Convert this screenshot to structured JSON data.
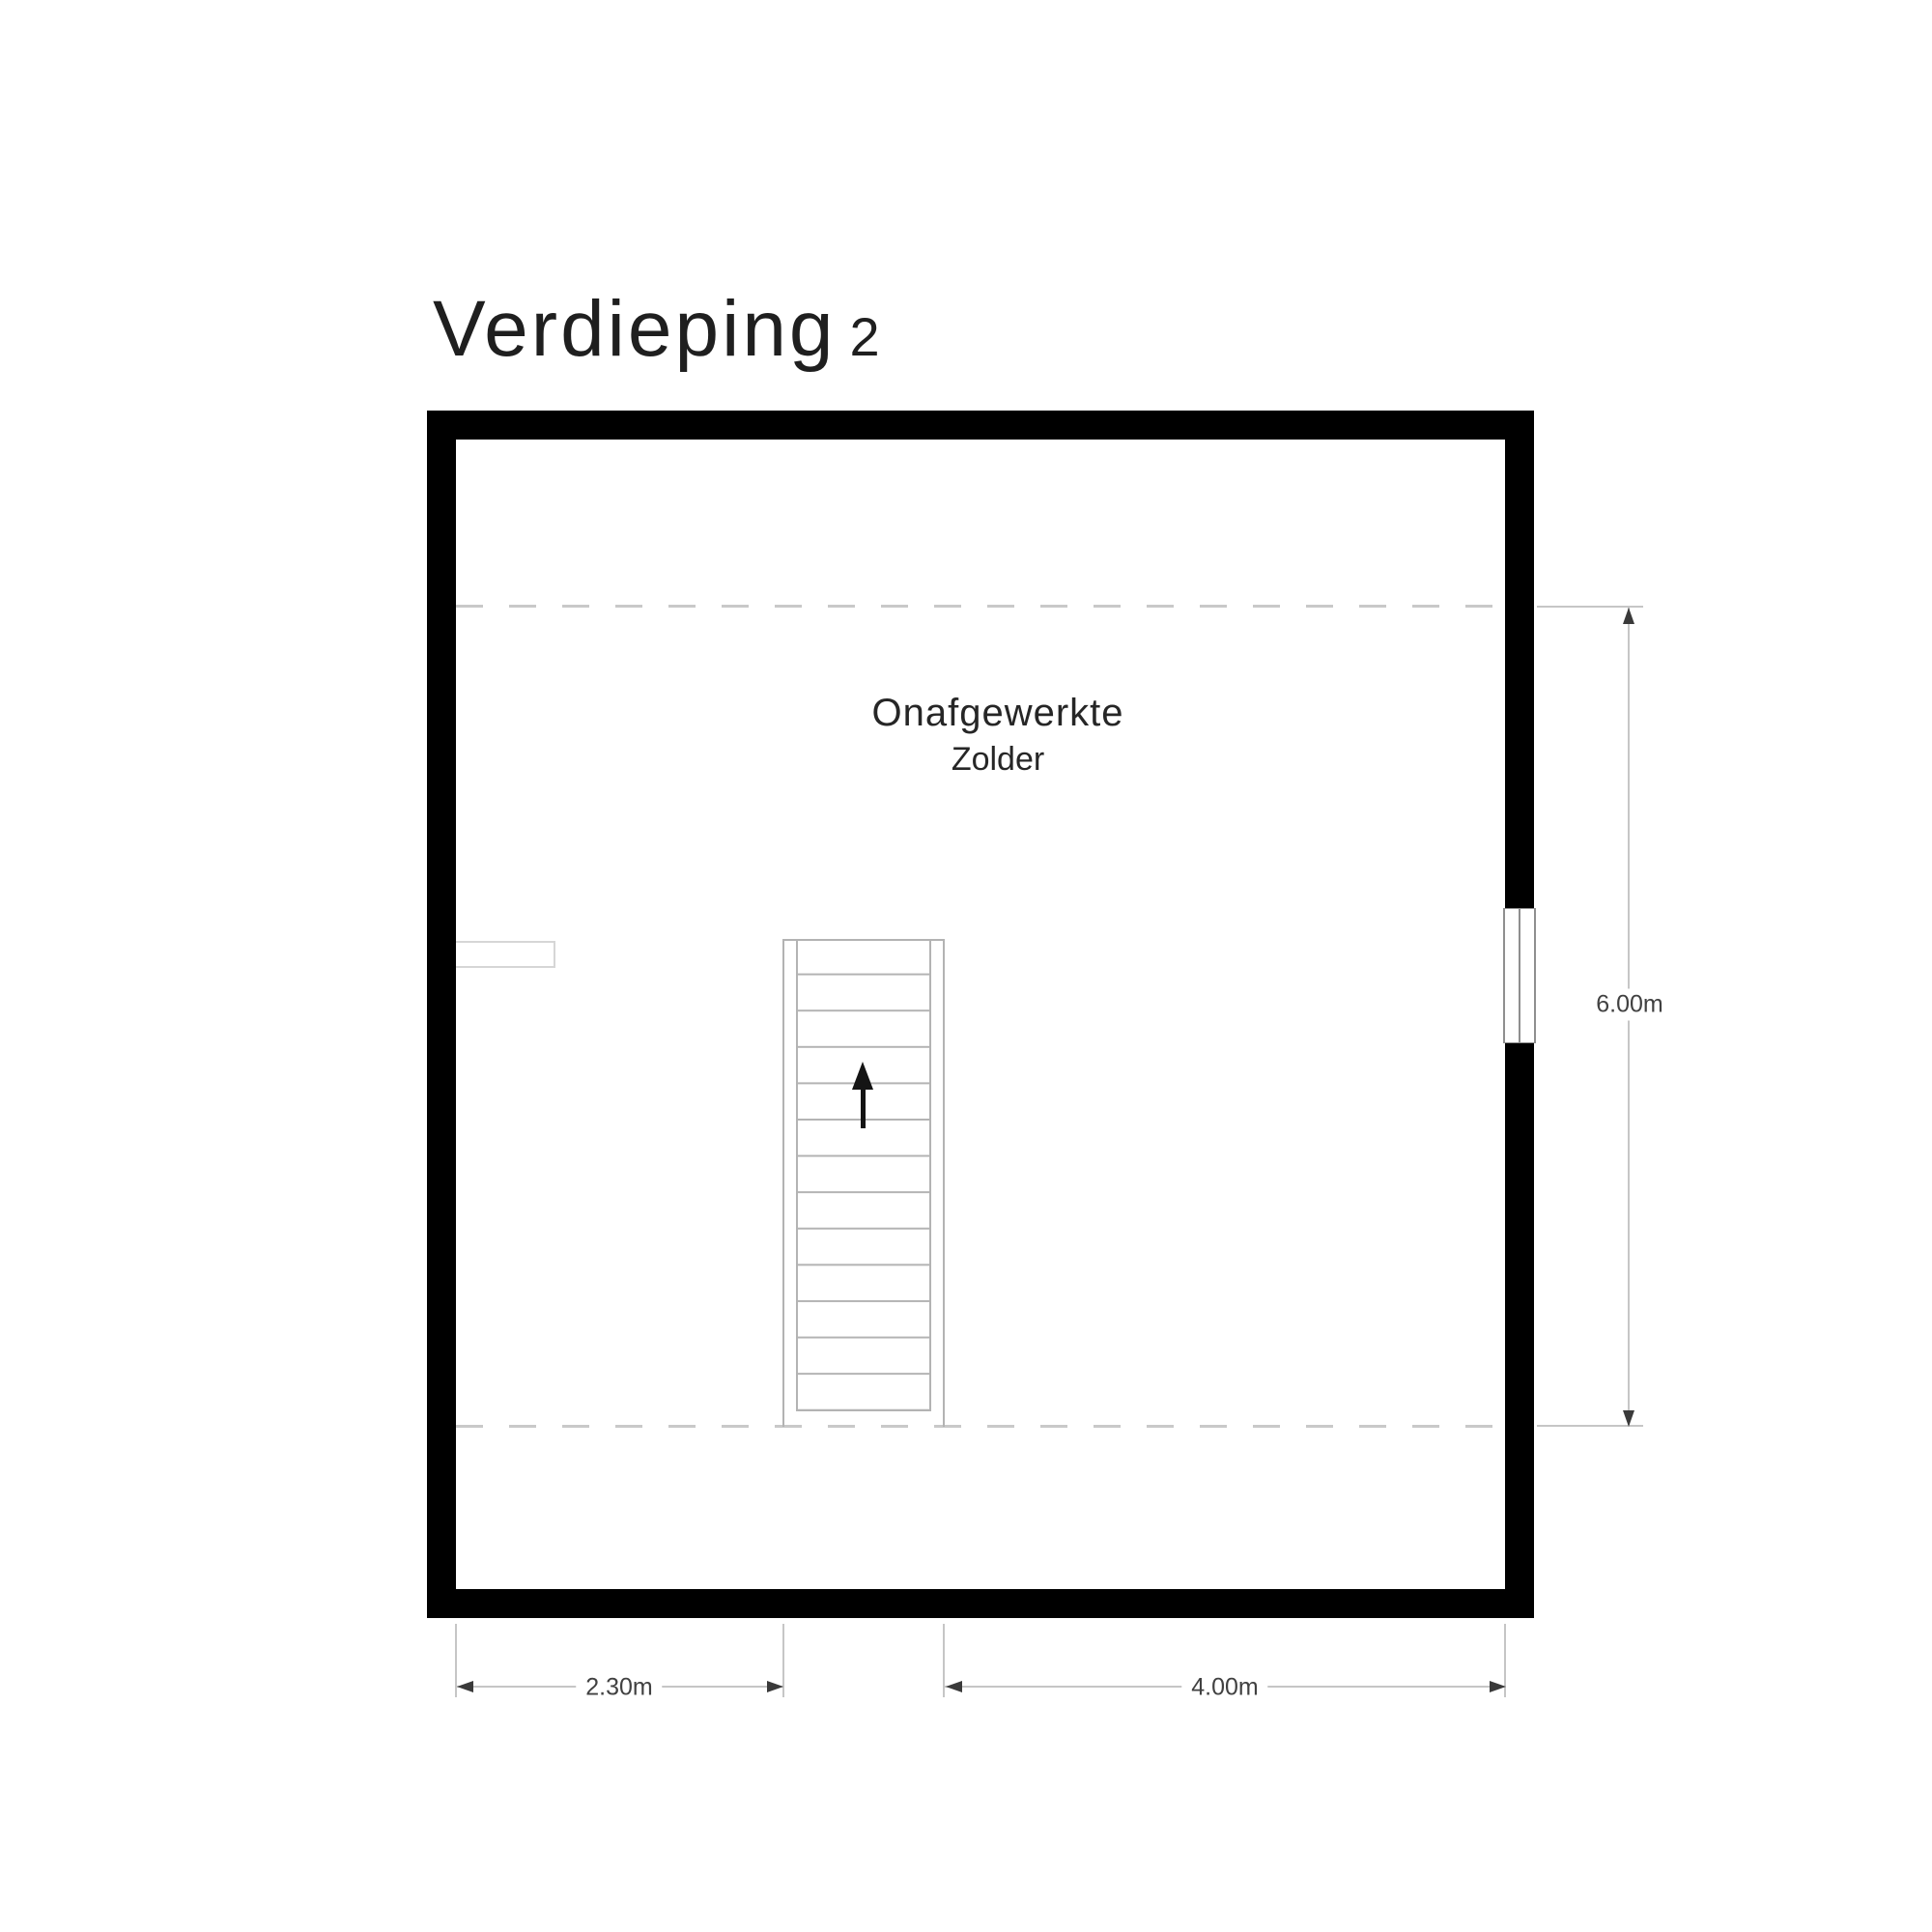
{
  "title": {
    "label": "Verdieping",
    "number": "2"
  },
  "room": {
    "name_line1": "Onafgewerkte",
    "name_line2": "Zolder"
  },
  "dimensions": {
    "right_height": "6.00m",
    "bottom_left_width": "2.30m",
    "bottom_right_width": "4.00m"
  },
  "icons": {
    "stairs_direction": "up-arrow"
  },
  "colors": {
    "wall": "#000000",
    "dashed_headroom_line": "#c9c9c9",
    "dimension_line": "#c6c6c6",
    "dimension_arrow": "#3a3a3a",
    "dimension_text": "#414141",
    "stair_line": "#b3b3b3",
    "title_text": "#1f1f1f",
    "background": "#ffffff"
  }
}
